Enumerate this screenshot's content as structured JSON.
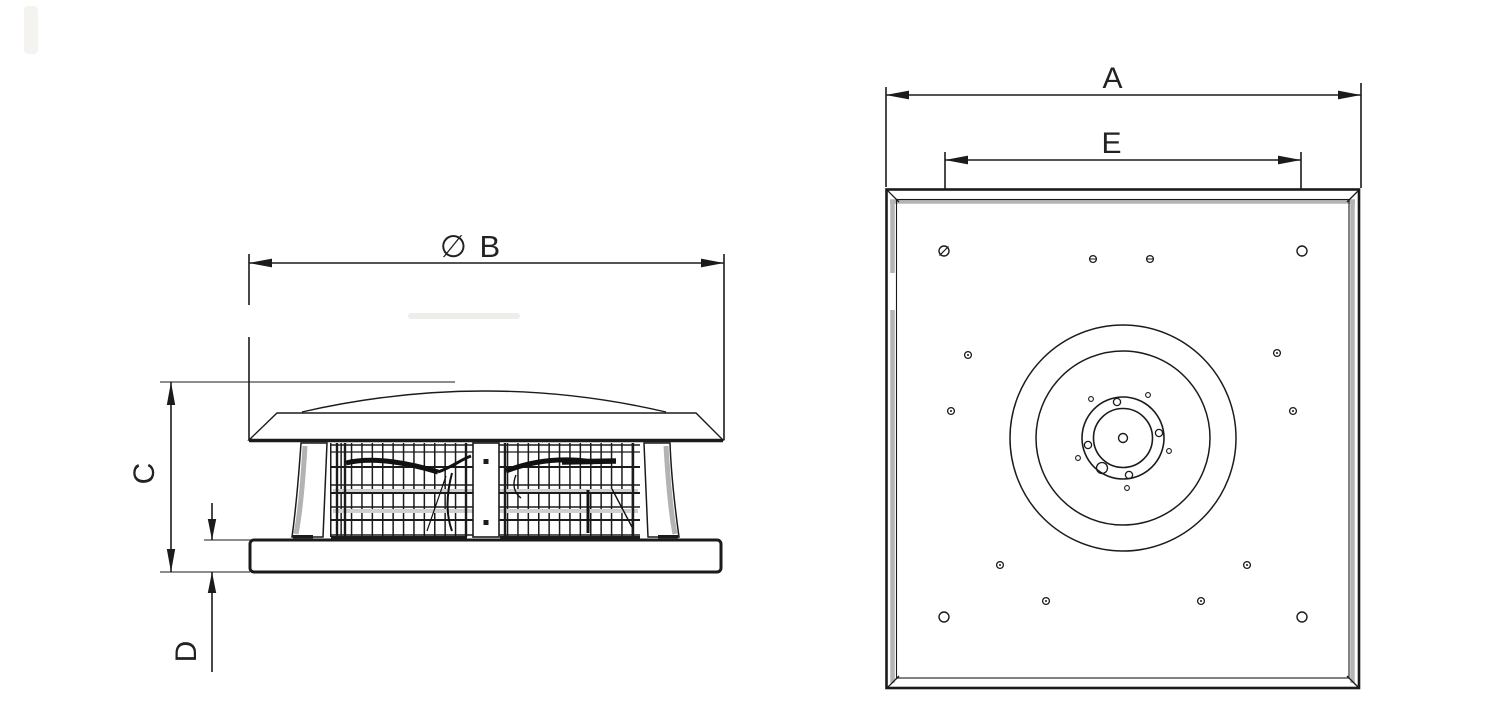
{
  "drawing": {
    "side_view": {
      "dim_diameter_label": "∅ B",
      "dim_height_label": "C",
      "dim_plate_thickness_label": "D"
    },
    "top_view": {
      "dim_width_label": "A",
      "dim_hole_pitch_label": "E"
    },
    "colors": {
      "line": "#1b1b1b",
      "shading_gray": "#b3b3b3",
      "grille_band_gray": "#cfcfcf",
      "background": "#ffffff",
      "text": "#2b2b2b"
    }
  }
}
